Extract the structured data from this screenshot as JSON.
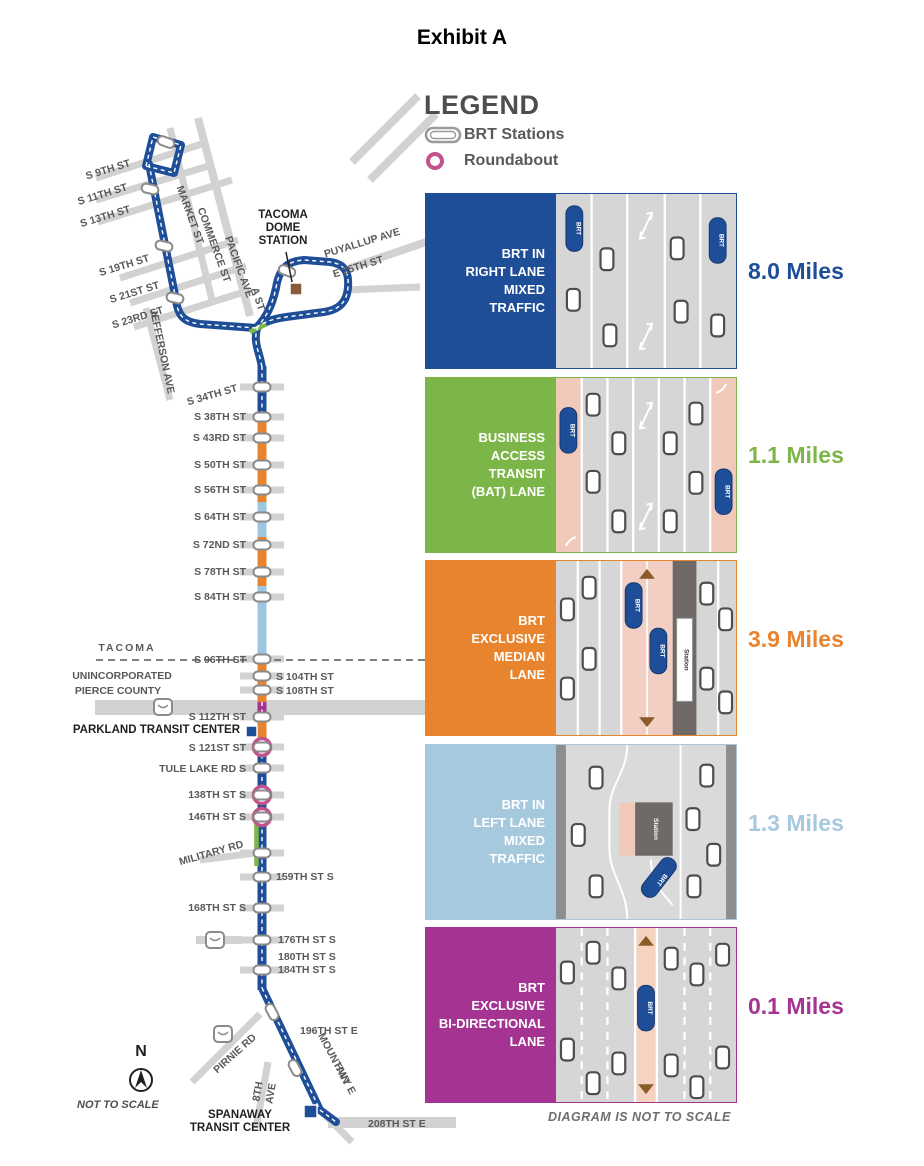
{
  "page_title": "Exhibit A",
  "legend": {
    "title": "LEGEND",
    "brt_stations_label": "BRT Stations",
    "roundabout_label": "Roundabout"
  },
  "lane_types": [
    {
      "id": "right-mixed",
      "label_lines": [
        "BRT IN",
        "RIGHT LANE",
        "MIXED",
        "TRAFFIC"
      ],
      "miles": "8.0 Miles",
      "color": "#1f4e99"
    },
    {
      "id": "bat",
      "label_lines": [
        "BUSINESS",
        "ACCESS",
        "TRANSIT",
        "(BAT) LANE"
      ],
      "miles": "1.1 Miles",
      "color": "#7cb648"
    },
    {
      "id": "median",
      "label_lines": [
        "BRT",
        "EXCLUSIVE",
        "MEDIAN",
        "LANE"
      ],
      "miles": "3.9 Miles",
      "color": "#e7842d"
    },
    {
      "id": "left-mixed",
      "label_lines": [
        "BRT IN",
        "LEFT LANE",
        "MIXED",
        "TRAFFIC"
      ],
      "miles": "1.3 Miles",
      "color": "#a7c9de"
    },
    {
      "id": "bidir",
      "label_lines": [
        "BRT",
        "EXCLUSIVE",
        "BI-DIRECTIONAL",
        "LANE"
      ],
      "miles": "0.1 Miles",
      "color": "#a43391"
    }
  ],
  "diagram_note": "DIAGRAM IS NOT TO SCALE",
  "bus_label": "BRT",
  "station_strip_label": "Station",
  "map": {
    "route_colors": {
      "navy": "#1f4e99",
      "orange": "#e7842d",
      "light_blue": "#9cc7e0",
      "green": "#7cb648",
      "purple": "#a43391"
    },
    "compass": {
      "n": "N",
      "note": "NOT TO SCALE",
      "x": 141,
      "y": 1056
    },
    "boundary_labels": [
      {
        "label": "TACOMA",
        "x": 127,
        "y": 651,
        "spacing": 2
      },
      {
        "label": "UNINCORPORATED",
        "x": 122,
        "y": 679,
        "spacing": 0
      },
      {
        "label": "PIERCE COUNTY",
        "x": 118,
        "y": 694,
        "spacing": 0
      }
    ],
    "street_names": [
      {
        "label": "MARKET ST",
        "x": 187,
        "y": 216,
        "rot": 70
      },
      {
        "label": "COMMERCE ST",
        "x": 211,
        "y": 246,
        "rot": 70
      },
      {
        "label": "PACIFIC AVE",
        "x": 236,
        "y": 268,
        "rot": 70
      },
      {
        "label": "JEFFERSON AVE",
        "x": 159,
        "y": 352,
        "rot": 78
      },
      {
        "label": "A ST",
        "x": 255,
        "y": 300,
        "rot": 72
      },
      {
        "label": "PUYALLUP AVE",
        "x": 363,
        "y": 246,
        "rot": -17
      },
      {
        "label": "E 25TH ST",
        "x": 359,
        "y": 270,
        "rot": -17
      },
      {
        "label": "PIRNIE RD",
        "x": 237,
        "y": 1056,
        "rot": -42
      },
      {
        "label": "MOUNTAIN",
        "x": 331,
        "y": 1060,
        "rot": 62
      },
      {
        "label": "HWY E",
        "x": 342,
        "y": 1080,
        "rot": 62
      },
      {
        "label": "8TH",
        "x": 261,
        "y": 1092,
        "rot": -80
      },
      {
        "label": "AVE",
        "x": 274,
        "y": 1094,
        "rot": -80
      }
    ],
    "stations": [
      {
        "label": "S 9TH ST",
        "lx": 131,
        "ly": 166,
        "anchor": "end",
        "lrot": -17,
        "marker": "none"
      },
      {
        "label": "S 11TH ST",
        "lx": 128,
        "ly": 190,
        "anchor": "end",
        "lrot": -17,
        "marker": "pill",
        "px": 150,
        "py": 189,
        "prot": 13
      },
      {
        "label": "S 13TH ST",
        "lx": 131,
        "ly": 212,
        "anchor": "end",
        "lrot": -17,
        "marker": "none"
      },
      {
        "label": "S 19TH ST",
        "lx": 150,
        "ly": 261,
        "anchor": "end",
        "lrot": -17,
        "marker": "pill",
        "px": 164,
        "py": 246,
        "prot": 13
      },
      {
        "label": "S 21ST ST",
        "lx": 160,
        "ly": 288,
        "anchor": "end",
        "lrot": -17,
        "marker": "none"
      },
      {
        "label": "S 23RD ST",
        "lx": 164,
        "ly": 313,
        "anchor": "end",
        "lrot": -17,
        "marker": "pill",
        "px": 175,
        "py": 298,
        "prot": 13
      },
      {
        "label": "S 34TH ST",
        "lx": 238,
        "ly": 391,
        "anchor": "end",
        "lrot": -16,
        "marker": "pill",
        "px": 262,
        "py": 387,
        "prot": 0,
        "bar": true
      },
      {
        "label": "S 38TH ST",
        "lx": 246,
        "ly": 420,
        "anchor": "end",
        "lrot": 0,
        "marker": "pill",
        "px": 262,
        "py": 417,
        "prot": 0,
        "bar": true
      },
      {
        "label": "S 43RD ST",
        "lx": 246,
        "ly": 441,
        "anchor": "end",
        "lrot": 0,
        "marker": "pill",
        "px": 262,
        "py": 438,
        "prot": 0,
        "bar": true
      },
      {
        "label": "S 50TH ST",
        "lx": 246,
        "ly": 468,
        "anchor": "end",
        "lrot": 0,
        "marker": "pill",
        "px": 262,
        "py": 465,
        "prot": 0,
        "bar": true
      },
      {
        "label": "S 56TH ST",
        "lx": 246,
        "ly": 493,
        "anchor": "end",
        "lrot": 0,
        "marker": "pill",
        "px": 262,
        "py": 490,
        "prot": 0,
        "bar": true
      },
      {
        "label": "S 64TH ST",
        "lx": 246,
        "ly": 520,
        "anchor": "end",
        "lrot": 0,
        "marker": "pill",
        "px": 262,
        "py": 517,
        "prot": 0,
        "bar": true
      },
      {
        "label": "S 72ND ST",
        "lx": 246,
        "ly": 548,
        "anchor": "end",
        "lrot": 0,
        "marker": "pill",
        "px": 262,
        "py": 545,
        "prot": 0,
        "bar": true
      },
      {
        "label": "S 78TH ST",
        "lx": 246,
        "ly": 575,
        "anchor": "end",
        "lrot": 0,
        "marker": "pill",
        "px": 262,
        "py": 572,
        "prot": 0,
        "bar": true
      },
      {
        "label": "S 84TH ST",
        "lx": 246,
        "ly": 600,
        "anchor": "end",
        "lrot": 0,
        "marker": "pill",
        "px": 262,
        "py": 597,
        "prot": 0,
        "bar": true
      },
      {
        "label": "S 96TH ST",
        "lx": 246,
        "ly": 663,
        "anchor": "end",
        "lrot": 0,
        "marker": "pill",
        "px": 262,
        "py": 659,
        "prot": 0,
        "bar": true
      },
      {
        "label": "S 104TH ST",
        "lx": 276,
        "ly": 680,
        "anchor": "start",
        "lrot": 0,
        "marker": "pill",
        "px": 262,
        "py": 676,
        "prot": 0,
        "bar": true
      },
      {
        "label": "S 108TH ST",
        "lx": 276,
        "ly": 694,
        "anchor": "start",
        "lrot": 0,
        "marker": "pill",
        "px": 262,
        "py": 690,
        "prot": 0,
        "bar": true
      },
      {
        "label": "S 112TH ST",
        "lx": 246,
        "ly": 720,
        "anchor": "end",
        "lrot": 0,
        "marker": "pill",
        "px": 262,
        "py": 717,
        "prot": 0,
        "bar": true
      },
      {
        "label": "S 121ST ST",
        "lx": 246,
        "ly": 751,
        "anchor": "end",
        "lrot": 0,
        "marker": "ring",
        "px": 262,
        "py": 747,
        "prot": 0,
        "bar": true
      },
      {
        "label": "TULE LAKE RD S",
        "lx": 246,
        "ly": 772,
        "anchor": "end",
        "lrot": 0,
        "marker": "pill",
        "px": 262,
        "py": 768,
        "prot": 0,
        "bar": true
      },
      {
        "label": "138TH ST S",
        "lx": 246,
        "ly": 798,
        "anchor": "end",
        "lrot": 0,
        "marker": "ring",
        "px": 262,
        "py": 795,
        "prot": 0,
        "bar": true
      },
      {
        "label": "146TH ST S",
        "lx": 246,
        "ly": 820,
        "anchor": "end",
        "lrot": 0,
        "marker": "ring",
        "px": 262,
        "py": 817,
        "prot": 0,
        "bar": true
      },
      {
        "label": "MILITARY RD",
        "lx": 244,
        "ly": 847,
        "anchor": "end",
        "lrot": -16,
        "marker": "pill",
        "px": 262,
        "py": 853,
        "prot": 0,
        "bar": true
      },
      {
        "label": "159TH ST S",
        "lx": 276,
        "ly": 880,
        "anchor": "start",
        "lrot": 0,
        "marker": "pill",
        "px": 262,
        "py": 877,
        "prot": 0,
        "bar": true
      },
      {
        "label": "168TH ST S",
        "lx": 246,
        "ly": 911,
        "anchor": "end",
        "lrot": 0,
        "marker": "pill",
        "px": 262,
        "py": 908,
        "prot": 0,
        "bar": true
      },
      {
        "label": "176TH ST S",
        "lx": 278,
        "ly": 943,
        "anchor": "start",
        "lrot": 0,
        "marker": "pill",
        "px": 262,
        "py": 940,
        "prot": 0,
        "bar": true
      },
      {
        "label": "180TH ST S",
        "lx": 278,
        "ly": 960,
        "anchor": "start",
        "lrot": 0,
        "marker": "none"
      },
      {
        "label": "184TH ST S",
        "lx": 278,
        "ly": 973,
        "anchor": "start",
        "lrot": 0,
        "marker": "pill",
        "px": 262,
        "py": 970,
        "prot": 0,
        "bar": true
      },
      {
        "label": "196TH ST E",
        "lx": 300,
        "ly": 1034,
        "anchor": "start",
        "lrot": 0,
        "marker": "pill",
        "px": 272,
        "py": 1012,
        "prot": 62
      },
      {
        "label": "208TH ST E",
        "lx": 368,
        "ly": 1127,
        "anchor": "start",
        "lrot": 0,
        "marker": "none"
      }
    ],
    "extra_pills": [
      {
        "px": 166,
        "py": 142,
        "prot": 20
      },
      {
        "px": 287,
        "py": 271,
        "prot": 20
      },
      {
        "px": 295,
        "py": 1068,
        "prot": 62
      }
    ],
    "transit_centers": [
      {
        "lines": [
          "TACOMA",
          "DOME",
          "STATION"
        ],
        "x": 283,
        "y": 218,
        "anchor": "middle",
        "sq_x": 290,
        "sq_y": 283,
        "sq_s": 12,
        "sq_c": "#8a5a3c",
        "callout": [
          286,
          252,
          292,
          282
        ]
      },
      {
        "lines": [
          "PARKLAND TRANSIT CENTER"
        ],
        "x": 240,
        "y": 733,
        "anchor": "end",
        "sq_x": 246,
        "sq_y": 726,
        "sq_s": 11,
        "sq_c": "#1f4e99"
      },
      {
        "lines": [
          "SPANAWAY",
          "TRANSIT CENTER"
        ],
        "x": 240,
        "y": 1118,
        "anchor": "middle",
        "sq_x": 304,
        "sq_y": 1105,
        "sq_s": 13,
        "sq_c": "#1f4e99"
      }
    ],
    "highway_shields": [
      {
        "x": 163,
        "y": 707
      },
      {
        "x": 215,
        "y": 940
      },
      {
        "x": 223,
        "y": 1034
      }
    ]
  }
}
